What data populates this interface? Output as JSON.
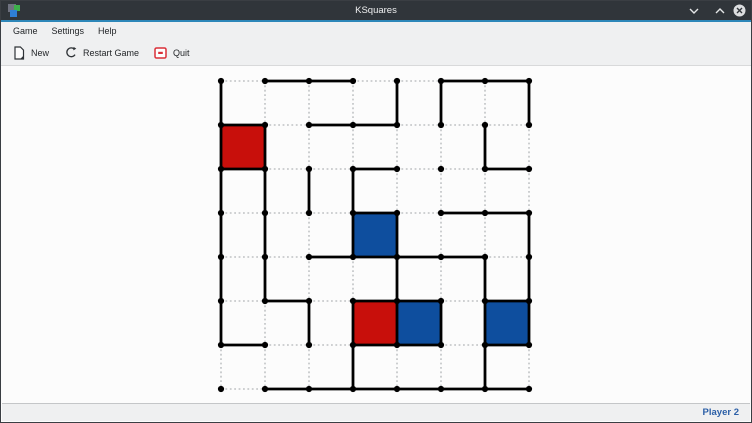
{
  "window": {
    "title": "KSquares",
    "titlebar_color": "#30353a",
    "accent_color": "#2d87b9",
    "controls": [
      {
        "name": "minimize"
      },
      {
        "name": "maximize"
      },
      {
        "name": "close"
      }
    ]
  },
  "menubar": {
    "items": [
      {
        "label": "Game"
      },
      {
        "label": "Settings"
      },
      {
        "label": "Help"
      }
    ]
  },
  "toolbar": {
    "buttons": [
      {
        "label": "New",
        "icon": "new-document-icon"
      },
      {
        "label": "Restart Game",
        "icon": "restart-icon"
      },
      {
        "label": "Quit",
        "icon": "quit-icon"
      }
    ]
  },
  "statusbar": {
    "current_player": "Player 2",
    "text_color": "#2b5fa7"
  },
  "board": {
    "dots_per_side": 8,
    "squares_per_side": 7,
    "dot_spacing": 44,
    "svg_offset": 8,
    "origin": {
      "x": 220,
      "y": 80
    },
    "colors": {
      "player1": "#c80f0b",
      "player2": "#0e4e9e",
      "line": "#000000",
      "dot": "#000000",
      "grid_dotted": "#b3b6b8"
    },
    "solid_h": [
      [
        0,
        1
      ],
      [
        0,
        2
      ],
      [
        0,
        5
      ],
      [
        0,
        6
      ],
      [
        1,
        0
      ],
      [
        1,
        2
      ],
      [
        1,
        3
      ],
      [
        2,
        0
      ],
      [
        2,
        3
      ],
      [
        2,
        6
      ],
      [
        3,
        3
      ],
      [
        3,
        5
      ],
      [
        3,
        6
      ],
      [
        4,
        2
      ],
      [
        4,
        3
      ],
      [
        4,
        4
      ],
      [
        4,
        5
      ],
      [
        5,
        1
      ],
      [
        5,
        3
      ],
      [
        5,
        4
      ],
      [
        5,
        6
      ],
      [
        6,
        0
      ],
      [
        6,
        3
      ],
      [
        6,
        4
      ],
      [
        6,
        6
      ],
      [
        7,
        1
      ],
      [
        7,
        2
      ],
      [
        7,
        3
      ],
      [
        7,
        4
      ],
      [
        7,
        5
      ],
      [
        7,
        6
      ]
    ],
    "solid_v": [
      [
        0,
        0
      ],
      [
        0,
        1
      ],
      [
        0,
        2
      ],
      [
        0,
        3
      ],
      [
        0,
        4
      ],
      [
        0,
        5
      ],
      [
        1,
        1
      ],
      [
        1,
        2
      ],
      [
        1,
        3
      ],
      [
        1,
        4
      ],
      [
        2,
        2
      ],
      [
        2,
        5
      ],
      [
        3,
        2
      ],
      [
        3,
        3
      ],
      [
        3,
        5
      ],
      [
        3,
        6
      ],
      [
        4,
        0
      ],
      [
        4,
        3
      ],
      [
        4,
        4
      ],
      [
        4,
        5
      ],
      [
        5,
        0
      ],
      [
        5,
        5
      ],
      [
        6,
        1
      ],
      [
        6,
        4
      ],
      [
        6,
        5
      ],
      [
        6,
        6
      ],
      [
        7,
        0
      ],
      [
        7,
        3
      ],
      [
        7,
        4
      ],
      [
        7,
        5
      ]
    ],
    "filled_squares": [
      {
        "row": 1,
        "col": 0,
        "player": 1
      },
      {
        "row": 3,
        "col": 3,
        "player": 2
      },
      {
        "row": 5,
        "col": 3,
        "player": 1
      },
      {
        "row": 5,
        "col": 4,
        "player": 2
      },
      {
        "row": 5,
        "col": 6,
        "player": 2
      }
    ]
  }
}
